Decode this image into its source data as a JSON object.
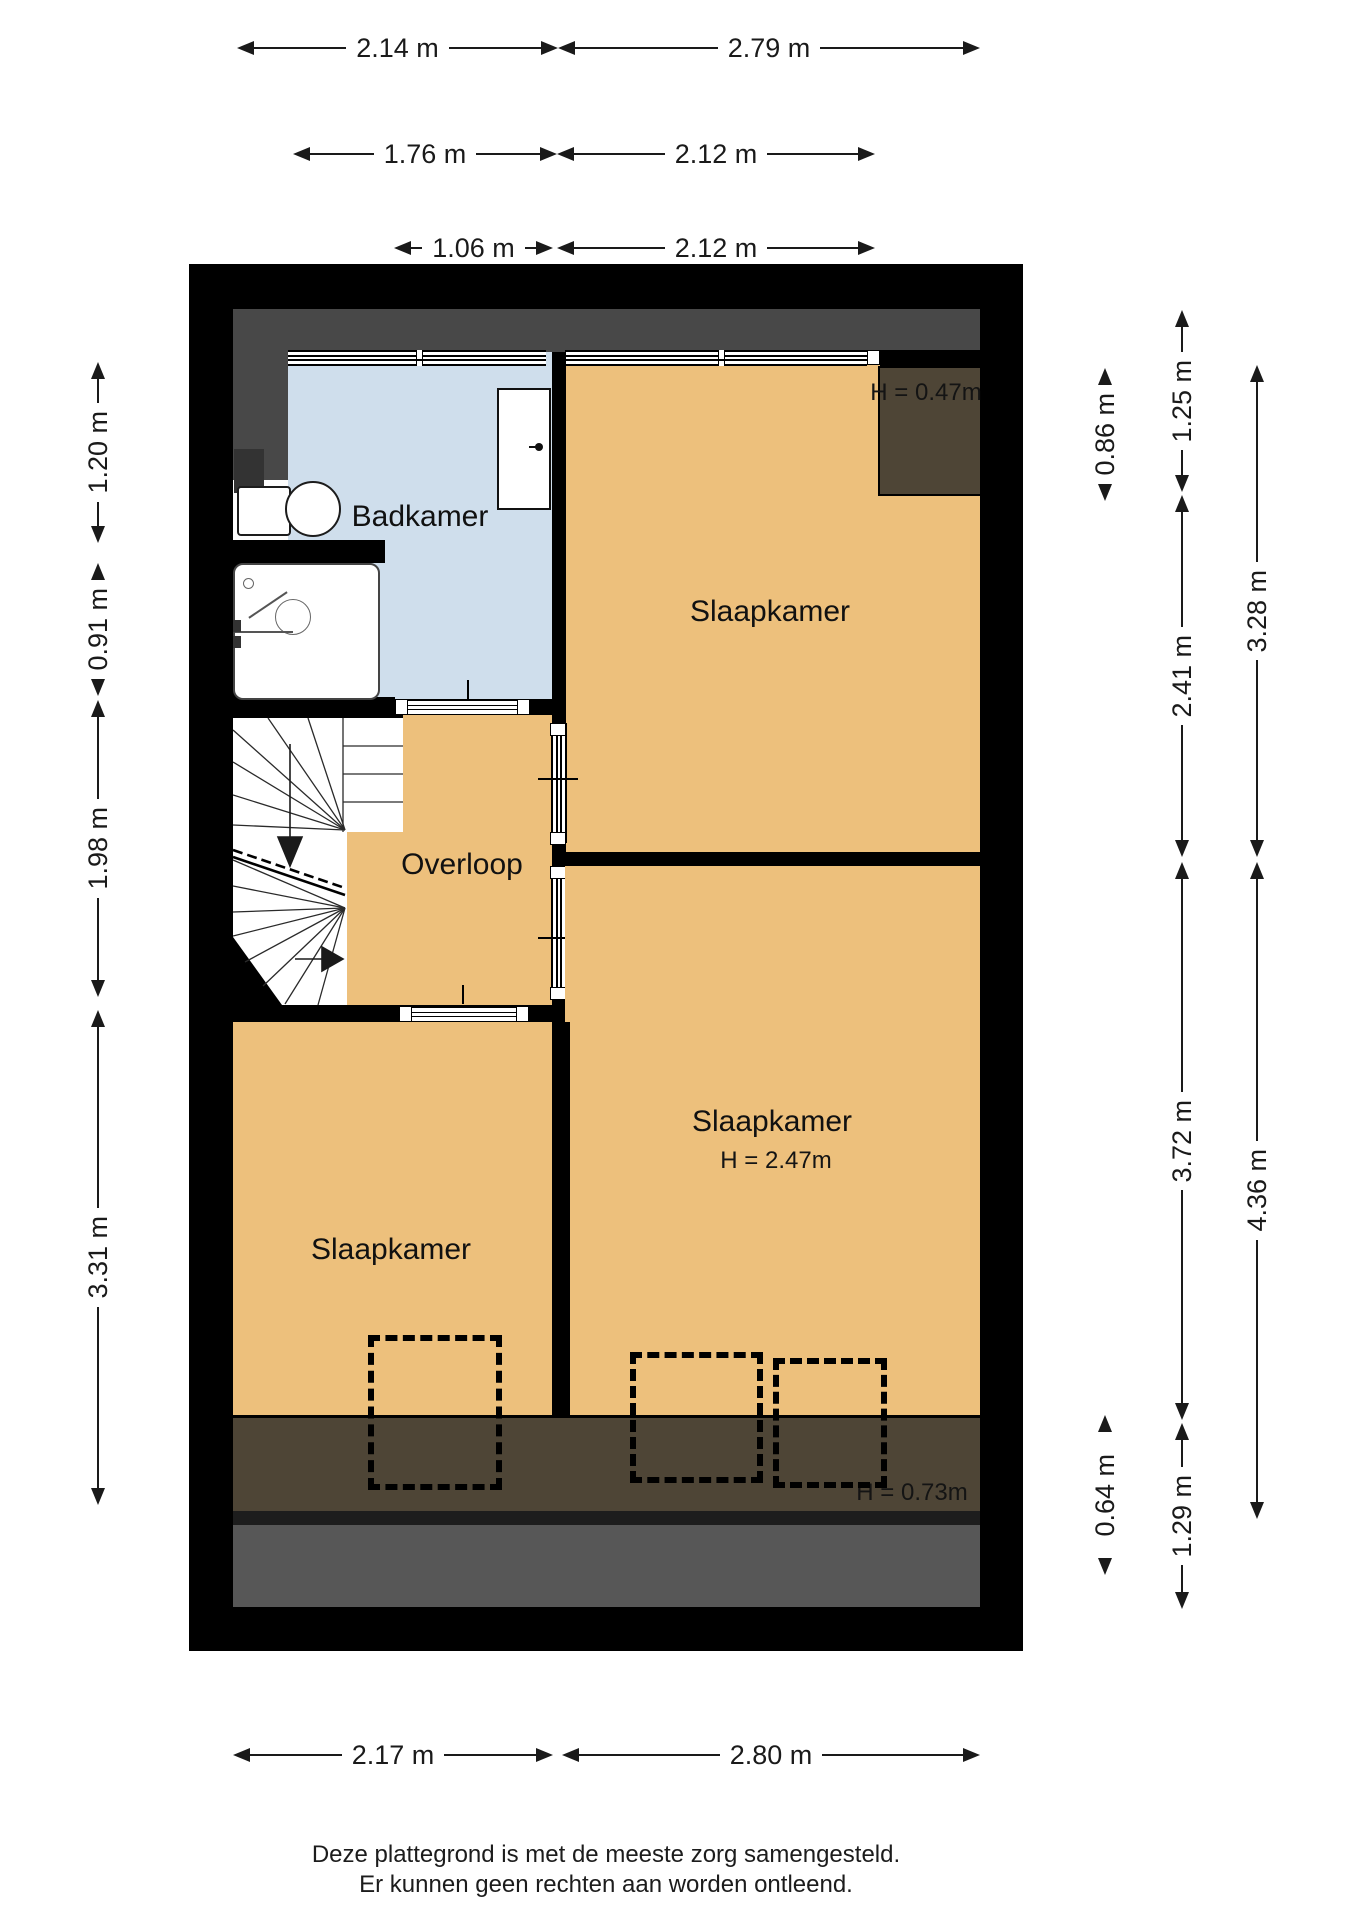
{
  "rooms": {
    "badkamer": "Badkamer",
    "slaapkamer_top": "Slaapkamer",
    "overloop": "Overloop",
    "slaapkamer_right": "Slaapkamer",
    "slaapkamer_left": "Slaapkamer"
  },
  "heights": {
    "attic_top": "H = 0.47m",
    "room": "H = 2.47m",
    "attic_bottom": "H = 0.73m"
  },
  "dims": {
    "t1a": "2.14 m",
    "t1b": "2.79 m",
    "t2a": "1.76 m",
    "t2b": "2.12 m",
    "t3a": "1.06 m",
    "t3b": "2.12 m",
    "l1": "1.20 m",
    "l2": "0.91 m",
    "l3": "1.98 m",
    "l4": "3.31 m",
    "r_inner_top": "0.86 m",
    "r_inner_bottom": "0.64 m",
    "r_mid1": "1.25 m",
    "r_mid2": "2.41 m",
    "r_mid3": "3.72 m",
    "r_mid4": "1.29 m",
    "r_out1": "3.28 m",
    "r_out2": "4.36 m",
    "b1": "2.17 m",
    "b2": "2.80 m"
  },
  "footer": {
    "line1": "Deze plattegrond is met de meeste zorg samengesteld.",
    "line2": "Er kunnen geen rechten aan worden ontleend."
  },
  "colors": {
    "floor": "#edc07c",
    "bath": "#cfdeec",
    "slope": "#484848",
    "attic": "#4e4536",
    "shadow_dark": "#1d1d1d",
    "shadow": "#575757",
    "wall": "#000000",
    "ink": "#1a1a1a",
    "line": "#111111"
  }
}
